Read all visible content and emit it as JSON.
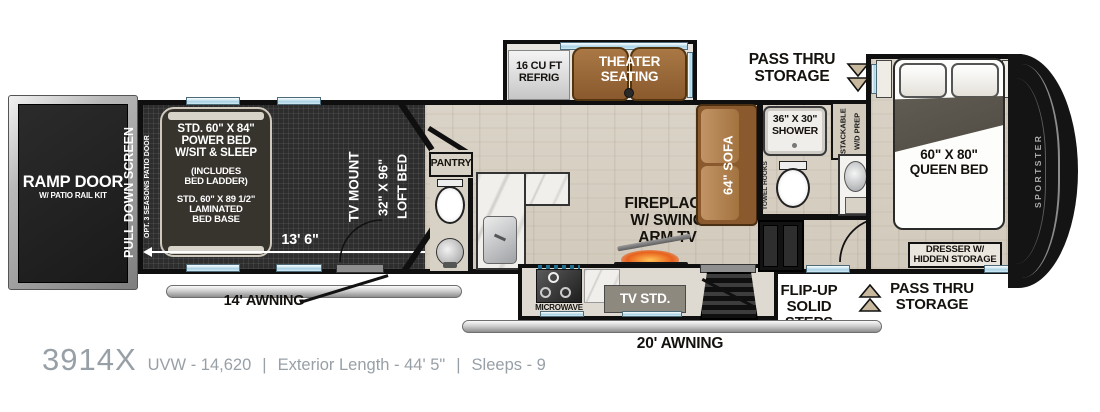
{
  "info": {
    "model": "3914X",
    "spec_uvw": "UVW - 14,620",
    "spec_length": "Exterior Length - 44' 5\"",
    "spec_sleeps": "Sleeps - 9",
    "divider": "|"
  },
  "brand": "SPORTSTER",
  "exterior": {
    "ramp_door": "RAMP DOOR",
    "ramp_door_sub": "W/ PATIO RAIL KIT",
    "pull_down_screen": "PULL DOWN SCREEN",
    "patio_door": "OPT. 3 SEASONS PATIO DOOR",
    "awning_14": "14' AWNING",
    "awning_20": "20' AWNING",
    "pass_thru": [
      "PASS THRU",
      "STORAGE"
    ],
    "steps": [
      "FLIP-UP",
      "SOLID STEPS"
    ]
  },
  "garage": {
    "power_bed": [
      "STD. 60\" X 84\"",
      "POWER BED",
      "W/SIT & SLEEP",
      "(INCLUDES",
      "BED LADDER)",
      "STD. 60\" X 89 1/2\"",
      "LAMINATED",
      "BED BASE"
    ],
    "tv_mount": "TV MOUNT",
    "loft_bed": [
      "32\" X 96\"",
      "LOFT BED"
    ],
    "dimension": "13' 6\""
  },
  "kitchen": {
    "pantry": "PANTRY",
    "refrig": [
      "16 CU FT",
      "REFRIG"
    ],
    "microwave": "MICROWAVE",
    "tv_stand": "TV STD."
  },
  "living": {
    "theater": [
      "THEATER",
      "SEATING"
    ],
    "fireplace": [
      "FIREPLACE",
      "W/ SWING",
      "ARM TV"
    ],
    "sofa": "64\" SOFA"
  },
  "bath": {
    "shower": [
      "36\" X 30\"",
      "SHOWER"
    ],
    "towel_hooks": "TOWEL HOOKS",
    "wd_prep": [
      "STACKABLE",
      "W/D PREP"
    ]
  },
  "bedroom": {
    "queen": [
      "60\" X 80\"",
      "QUEEN BED"
    ],
    "dresser": [
      "DRESSER W/",
      "HIDDEN STORAGE"
    ]
  },
  "colors": {
    "wall": "#0f0f0f",
    "wood_floor": "#d6cfc2",
    "garage_floor": "#2d2d2d",
    "window_glass": "#a9d2e4",
    "furniture_brown": "#9a6a3b",
    "awning_gray": "#c9c9c9",
    "fire_glow": "#e8611c",
    "info_text_gray": "#98a0a7"
  }
}
